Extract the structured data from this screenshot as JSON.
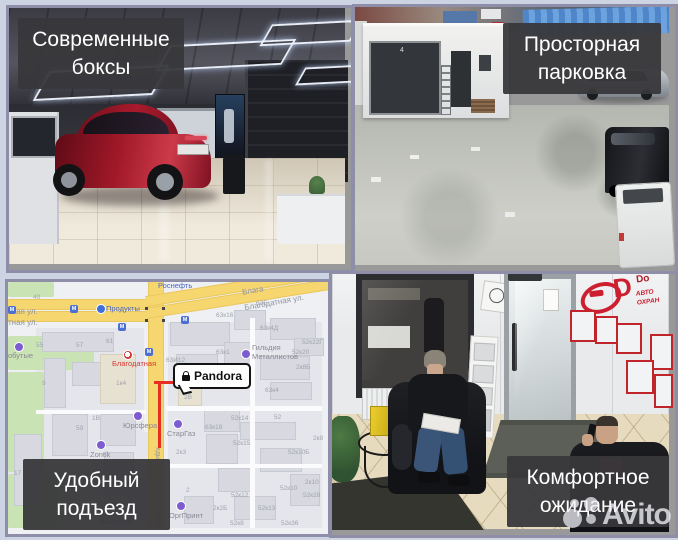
{
  "captions": {
    "boxes": "Современные\nбоксы",
    "parking": "Просторная\nпарковка",
    "entrance": "Удобный\nподъезд",
    "waiting": "Комфортное\nожидание"
  },
  "watermark": {
    "brand": "Avito"
  },
  "garage": {
    "poster_text": "DX90"
  },
  "parking_lot": {
    "door_number": "4"
  },
  "office": {
    "logo_letter": "D",
    "logo_name": "Do",
    "logo_line1": "АВТО",
    "logo_line2": "ОХРАН"
  },
  "map": {
    "marker_label": "Pandora",
    "metro_letter": "М",
    "streets": {
      "left1": "тная ул.",
      "left2": "тная ул.",
      "diag_top": "Блага",
      "diag_main": "Благодатная ул.",
      "vert1": "хды",
      "vert2": "прд"
    },
    "pois": [
      {
        "name": "Роснефть"
      },
      {
        "name": "Продукты"
      },
      {
        "name": "Благодатная"
      },
      {
        "name": "обутые"
      },
      {
        "name": "Юрсфера"
      },
      {
        "name": "Zontik"
      },
      {
        "name": "СтарГаз"
      },
      {
        "name": "ОргПринт"
      },
      {
        "name": "Гильдия\nМеталлистов"
      },
      {
        "name": "ьер"
      },
      {
        "name": "Вишенка"
      }
    ],
    "buildings": [
      "40",
      "55",
      "57",
      "61",
      "9",
      "1к4",
      "63И12",
      "63к16",
      "63Б",
      "63к4Д",
      "52к22Г",
      "52к20",
      "2к8Б",
      "63к1",
      "63к4",
      "2В",
      "2А",
      "1В",
      "59",
      "17",
      "7",
      "2к3",
      "52к14",
      "52",
      "63к18",
      "52к15",
      "52к10Б",
      "2к8",
      "2к10",
      "52к10",
      "52к28",
      "52к12",
      "2к2Б",
      "52к13",
      "52к8",
      "52к36",
      "2"
    ]
  }
}
